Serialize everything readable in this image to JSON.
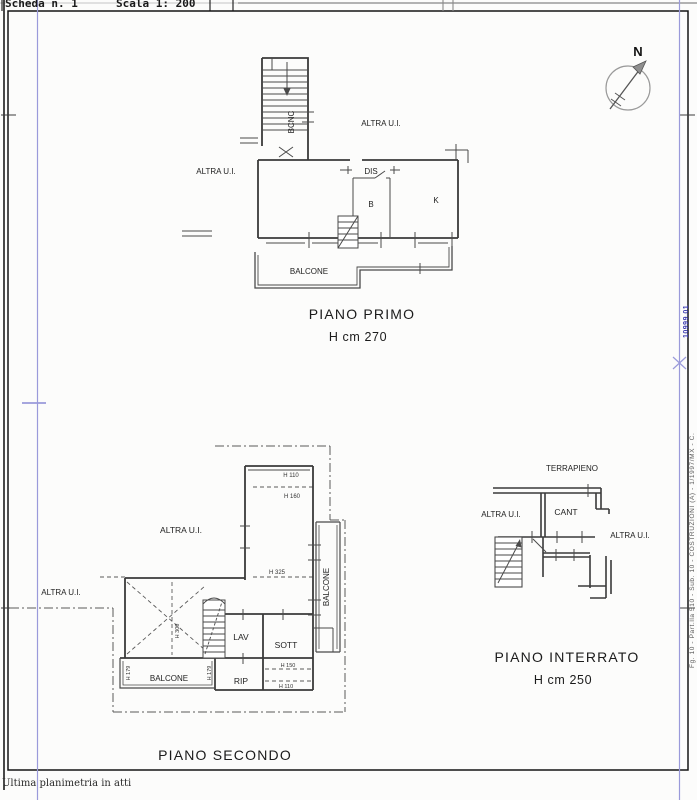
{
  "header": {
    "scheda": "Scheda n. 1",
    "scala": "Scala 1: 200"
  },
  "footer": {
    "note": "Ultima planimetria in atti"
  },
  "margin": {
    "stamp": "10999.01",
    "annotation": "Fg. 10 - Part.lla 510 - Sub. 10 - COSTRUZIONI (A) - 1/1997/MX - C."
  },
  "north": {
    "label": "N"
  },
  "piano_primo": {
    "title": "PIANO PRIMO",
    "height": "H cm 270",
    "rooms": {
      "bcnc": "BCNC",
      "altra_top": "ALTRA U.I.",
      "altra_left": "ALTRA U.I.",
      "dis": "DIS",
      "b": "B",
      "k": "K",
      "balcone": "BALCONE"
    }
  },
  "piano_secondo": {
    "title": "PIANO SECONDO",
    "rooms": {
      "altra_center": "ALTRA U.I.",
      "altra_left": "ALTRA U.I.",
      "lav": "LAV",
      "sott": "SOTT",
      "rip": "RIP",
      "balcone_bottom": "BALCONE",
      "balcone_right": "BALCONE"
    },
    "heights": {
      "h110_top": "H 110",
      "h160": "H 160",
      "h325": "H 325",
      "h300": "H 300",
      "h179_left": "H 179",
      "h179_right": "H 179",
      "h150": "H 150",
      "h110_low": "H 110"
    }
  },
  "piano_interrato": {
    "title": "PIANO INTERRATO",
    "height": "H cm 250",
    "rooms": {
      "terrapieno": "TERRAPIENO",
      "altra_left": "ALTRA U.I.",
      "cant": "CANT",
      "altra_right": "ALTRA U.I."
    }
  },
  "colors": {
    "line": "#3a3a3a",
    "fold_line": "#9a9ada",
    "stamp_blue": "#3b3bb0"
  }
}
